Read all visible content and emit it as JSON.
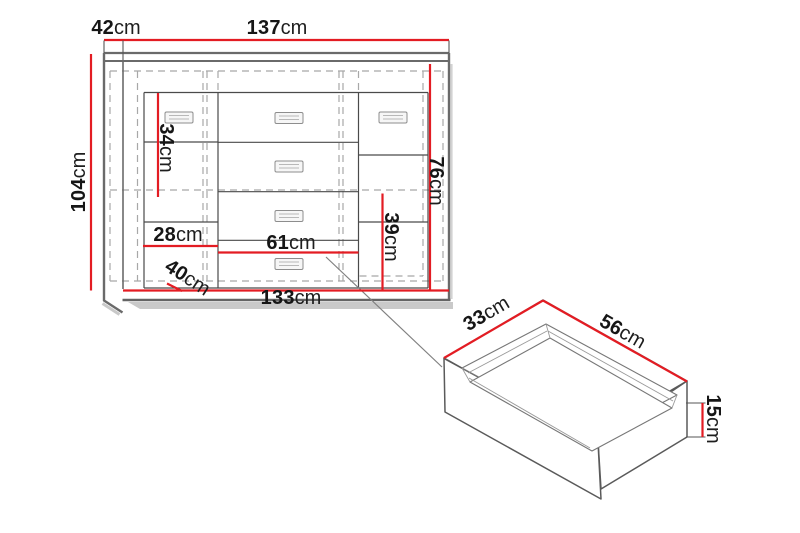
{
  "diagram_type": "furniture-technical-drawing",
  "colors": {
    "dimension_red": "#e31c23",
    "outline_gray": "#6a6a6a",
    "hidden_edge_gray": "#a8a8a8",
    "text_black": "#161616",
    "background": "#ffffff"
  },
  "dimensions": {
    "cabinet": {
      "top_depth": {
        "value": "42",
        "unit": "cm"
      },
      "top_width": {
        "value": "137",
        "unit": "cm"
      },
      "height": {
        "value": "104",
        "unit": "cm"
      },
      "left_shelf_gap": {
        "value": "34",
        "unit": "cm"
      },
      "interior_height": {
        "value": "76",
        "unit": "cm"
      },
      "left_compartment": {
        "value": "28",
        "unit": "cm"
      },
      "drawer_width": {
        "value": "61",
        "unit": "cm"
      },
      "right_lower_gap": {
        "value": "39",
        "unit": "cm"
      },
      "bottom_depth": {
        "value": "40",
        "unit": "cm"
      },
      "bottom_width": {
        "value": "133",
        "unit": "cm"
      }
    },
    "drawer": {
      "depth": {
        "value": "33",
        "unit": "cm"
      },
      "width": {
        "value": "56",
        "unit": "cm"
      },
      "height": {
        "value": "15",
        "unit": "cm"
      }
    }
  }
}
